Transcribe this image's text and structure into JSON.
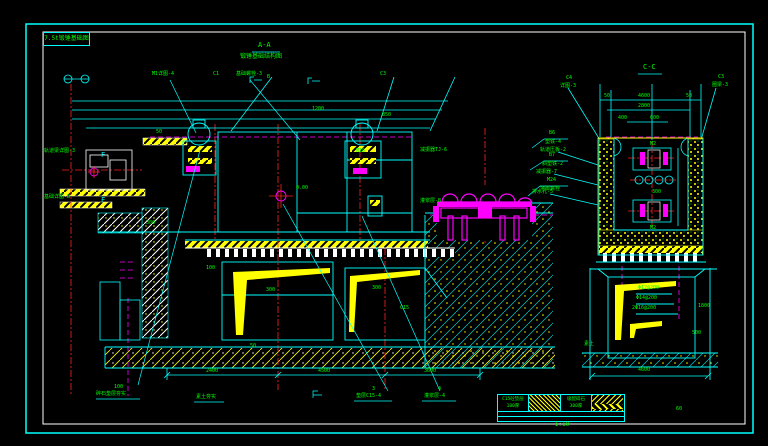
{
  "frame": {
    "title_box": "7.5t锻锤基础图"
  },
  "views": {
    "main": {
      "title": "A-A",
      "subtitle": "锻锤基础结构图"
    },
    "side": {
      "title": "C-C"
    }
  },
  "legend": {
    "col1_line1": "C15砼垫层",
    "col1_line2": "100厚",
    "col3_line1": "级配碎石",
    "col3_line2": "300厚",
    "scale": "1:10",
    "note": "60"
  },
  "palette": {
    "line": "#00ffff",
    "dim_text": "#00ff00",
    "hatch": "#ffff00",
    "equipment": "#ff00ff",
    "centerline": "#ff2222",
    "frame_inner": "#ffffff",
    "background": "#000000"
  },
  "labels": [
    {
      "t": "M1详图-4",
      "x": 152,
      "y": 72,
      "c": "g"
    },
    {
      "t": "C1",
      "x": 213,
      "y": 72,
      "c": "g"
    },
    {
      "t": "基础螺栓-3",
      "x": 236,
      "y": 72,
      "c": "g"
    },
    {
      "t": "B",
      "x": 267,
      "y": 75,
      "c": "g"
    },
    {
      "t": "C3",
      "x": 380,
      "y": 72,
      "c": "g"
    },
    {
      "t": "1200",
      "x": 312,
      "y": 107,
      "c": "g"
    },
    {
      "t": "850",
      "x": 382,
      "y": 113,
      "c": "g"
    },
    {
      "t": "A-A",
      "x": 258,
      "y": 42,
      "c": "g",
      "s": 7,
      "n": "main-view-title"
    },
    {
      "t": "锻锤基础结构图",
      "x": 240,
      "y": 54,
      "c": "g",
      "s": 6,
      "n": "main-view-subtitle"
    },
    {
      "t": "轨道梁详图-3",
      "x": 44,
      "y": 149,
      "c": "g"
    },
    {
      "t": "F",
      "x": 101,
      "y": 152,
      "c": "c",
      "s": 7,
      "n": "section-mark-f"
    },
    {
      "t": "基础详图-B",
      "x": 44,
      "y": 195,
      "c": "g"
    },
    {
      "t": "F",
      "x": 101,
      "y": 197,
      "c": "c",
      "s": 7,
      "n": "section-mark-f"
    },
    {
      "t": "50",
      "x": 156,
      "y": 130,
      "c": "g"
    },
    {
      "t": "300",
      "x": 146,
      "y": 221,
      "c": "g"
    },
    {
      "t": "减振器TJ-6",
      "x": 420,
      "y": 148,
      "c": "g"
    },
    {
      "t": "灌浆层-B",
      "x": 420,
      "y": 199,
      "c": "g"
    },
    {
      "t": "M16",
      "x": 356,
      "y": 149,
      "c": "g"
    },
    {
      "t": "0.00",
      "x": 296,
      "y": 186,
      "c": "g"
    },
    {
      "t": "B6",
      "x": 549,
      "y": 131,
      "c": "g"
    },
    {
      "t": "垫铁-4",
      "x": 545,
      "y": 140,
      "c": "g"
    },
    {
      "t": "B7",
      "x": 549,
      "y": 153,
      "c": "g"
    },
    {
      "t": "斜垫铁-2",
      "x": 542,
      "y": 162,
      "c": "g"
    },
    {
      "t": "M24",
      "x": 547,
      "y": 178,
      "c": "g"
    },
    {
      "t": "地脚螺栓",
      "x": 540,
      "y": 187,
      "c": "g"
    },
    {
      "t": "300",
      "x": 266,
      "y": 288,
      "c": "g"
    },
    {
      "t": "300",
      "x": 372,
      "y": 286,
      "c": "g"
    },
    {
      "t": "C15",
      "x": 400,
      "y": 306,
      "c": "g"
    },
    {
      "t": "100",
      "x": 206,
      "y": 266,
      "c": "g"
    },
    {
      "t": "50",
      "x": 250,
      "y": 344,
      "c": "g"
    },
    {
      "t": "2400",
      "x": 206,
      "y": 369,
      "c": "g"
    },
    {
      "t": "4500",
      "x": 318,
      "y": 369,
      "c": "g"
    },
    {
      "t": "3600",
      "x": 424,
      "y": 369,
      "c": "g"
    },
    {
      "t": "100",
      "x": 114,
      "y": 385,
      "c": "g"
    },
    {
      "t": "碎石垫层夯实",
      "x": 96,
      "y": 392,
      "c": "g"
    },
    {
      "t": "素土夯实",
      "x": 196,
      "y": 395,
      "c": "g"
    },
    {
      "t": "3",
      "x": 372,
      "y": 387,
      "c": "g"
    },
    {
      "t": "垫层C15-4",
      "x": 356,
      "y": 394,
      "c": "g"
    },
    {
      "t": "4",
      "x": 438,
      "y": 387,
      "c": "g"
    },
    {
      "t": "灌浆层-4",
      "x": 424,
      "y": 394,
      "c": "g"
    },
    {
      "t": "C-C",
      "x": 643,
      "y": 64,
      "c": "g",
      "s": 7,
      "n": "side-view-title"
    },
    {
      "t": "C4",
      "x": 566,
      "y": 76,
      "c": "g"
    },
    {
      "t": "详图-3",
      "x": 560,
      "y": 84,
      "c": "g"
    },
    {
      "t": "C3",
      "x": 718,
      "y": 75,
      "c": "g"
    },
    {
      "t": "圈梁-3",
      "x": 712,
      "y": 83,
      "c": "g"
    },
    {
      "t": "50",
      "x": 604,
      "y": 94,
      "c": "g"
    },
    {
      "t": "4600",
      "x": 638,
      "y": 94,
      "c": "g"
    },
    {
      "t": "50",
      "x": 686,
      "y": 94,
      "c": "g"
    },
    {
      "t": "2800",
      "x": 638,
      "y": 104,
      "c": "g"
    },
    {
      "t": "400",
      "x": 618,
      "y": 116,
      "c": "g"
    },
    {
      "t": "600",
      "x": 650,
      "y": 116,
      "c": "g"
    },
    {
      "t": "轨道压板-2",
      "x": 540,
      "y": 148,
      "c": "g"
    },
    {
      "t": "减振器-7",
      "x": 536,
      "y": 170,
      "c": "g"
    },
    {
      "t": "排水孔-5",
      "x": 532,
      "y": 190,
      "c": "g"
    },
    {
      "t": "M2",
      "x": 650,
      "y": 142,
      "c": "g"
    },
    {
      "t": "300",
      "x": 652,
      "y": 190,
      "c": "g"
    },
    {
      "t": "M2",
      "x": 650,
      "y": 226,
      "c": "g"
    },
    {
      "t": "Φ12@200",
      "x": 638,
      "y": 286,
      "c": "g"
    },
    {
      "t": "Φ14@200",
      "x": 636,
      "y": 296,
      "c": "g"
    },
    {
      "t": "2Φ16@200",
      "x": 632,
      "y": 306,
      "c": "g"
    },
    {
      "t": "1800",
      "x": 698,
      "y": 304,
      "c": "g"
    },
    {
      "t": "500",
      "x": 692,
      "y": 331,
      "c": "g"
    },
    {
      "t": "4600",
      "x": 638,
      "y": 368,
      "c": "g"
    },
    {
      "t": "素土",
      "x": 584,
      "y": 342,
      "c": "g"
    },
    {
      "t": "60",
      "x": 676,
      "y": 407,
      "c": "g"
    }
  ]
}
